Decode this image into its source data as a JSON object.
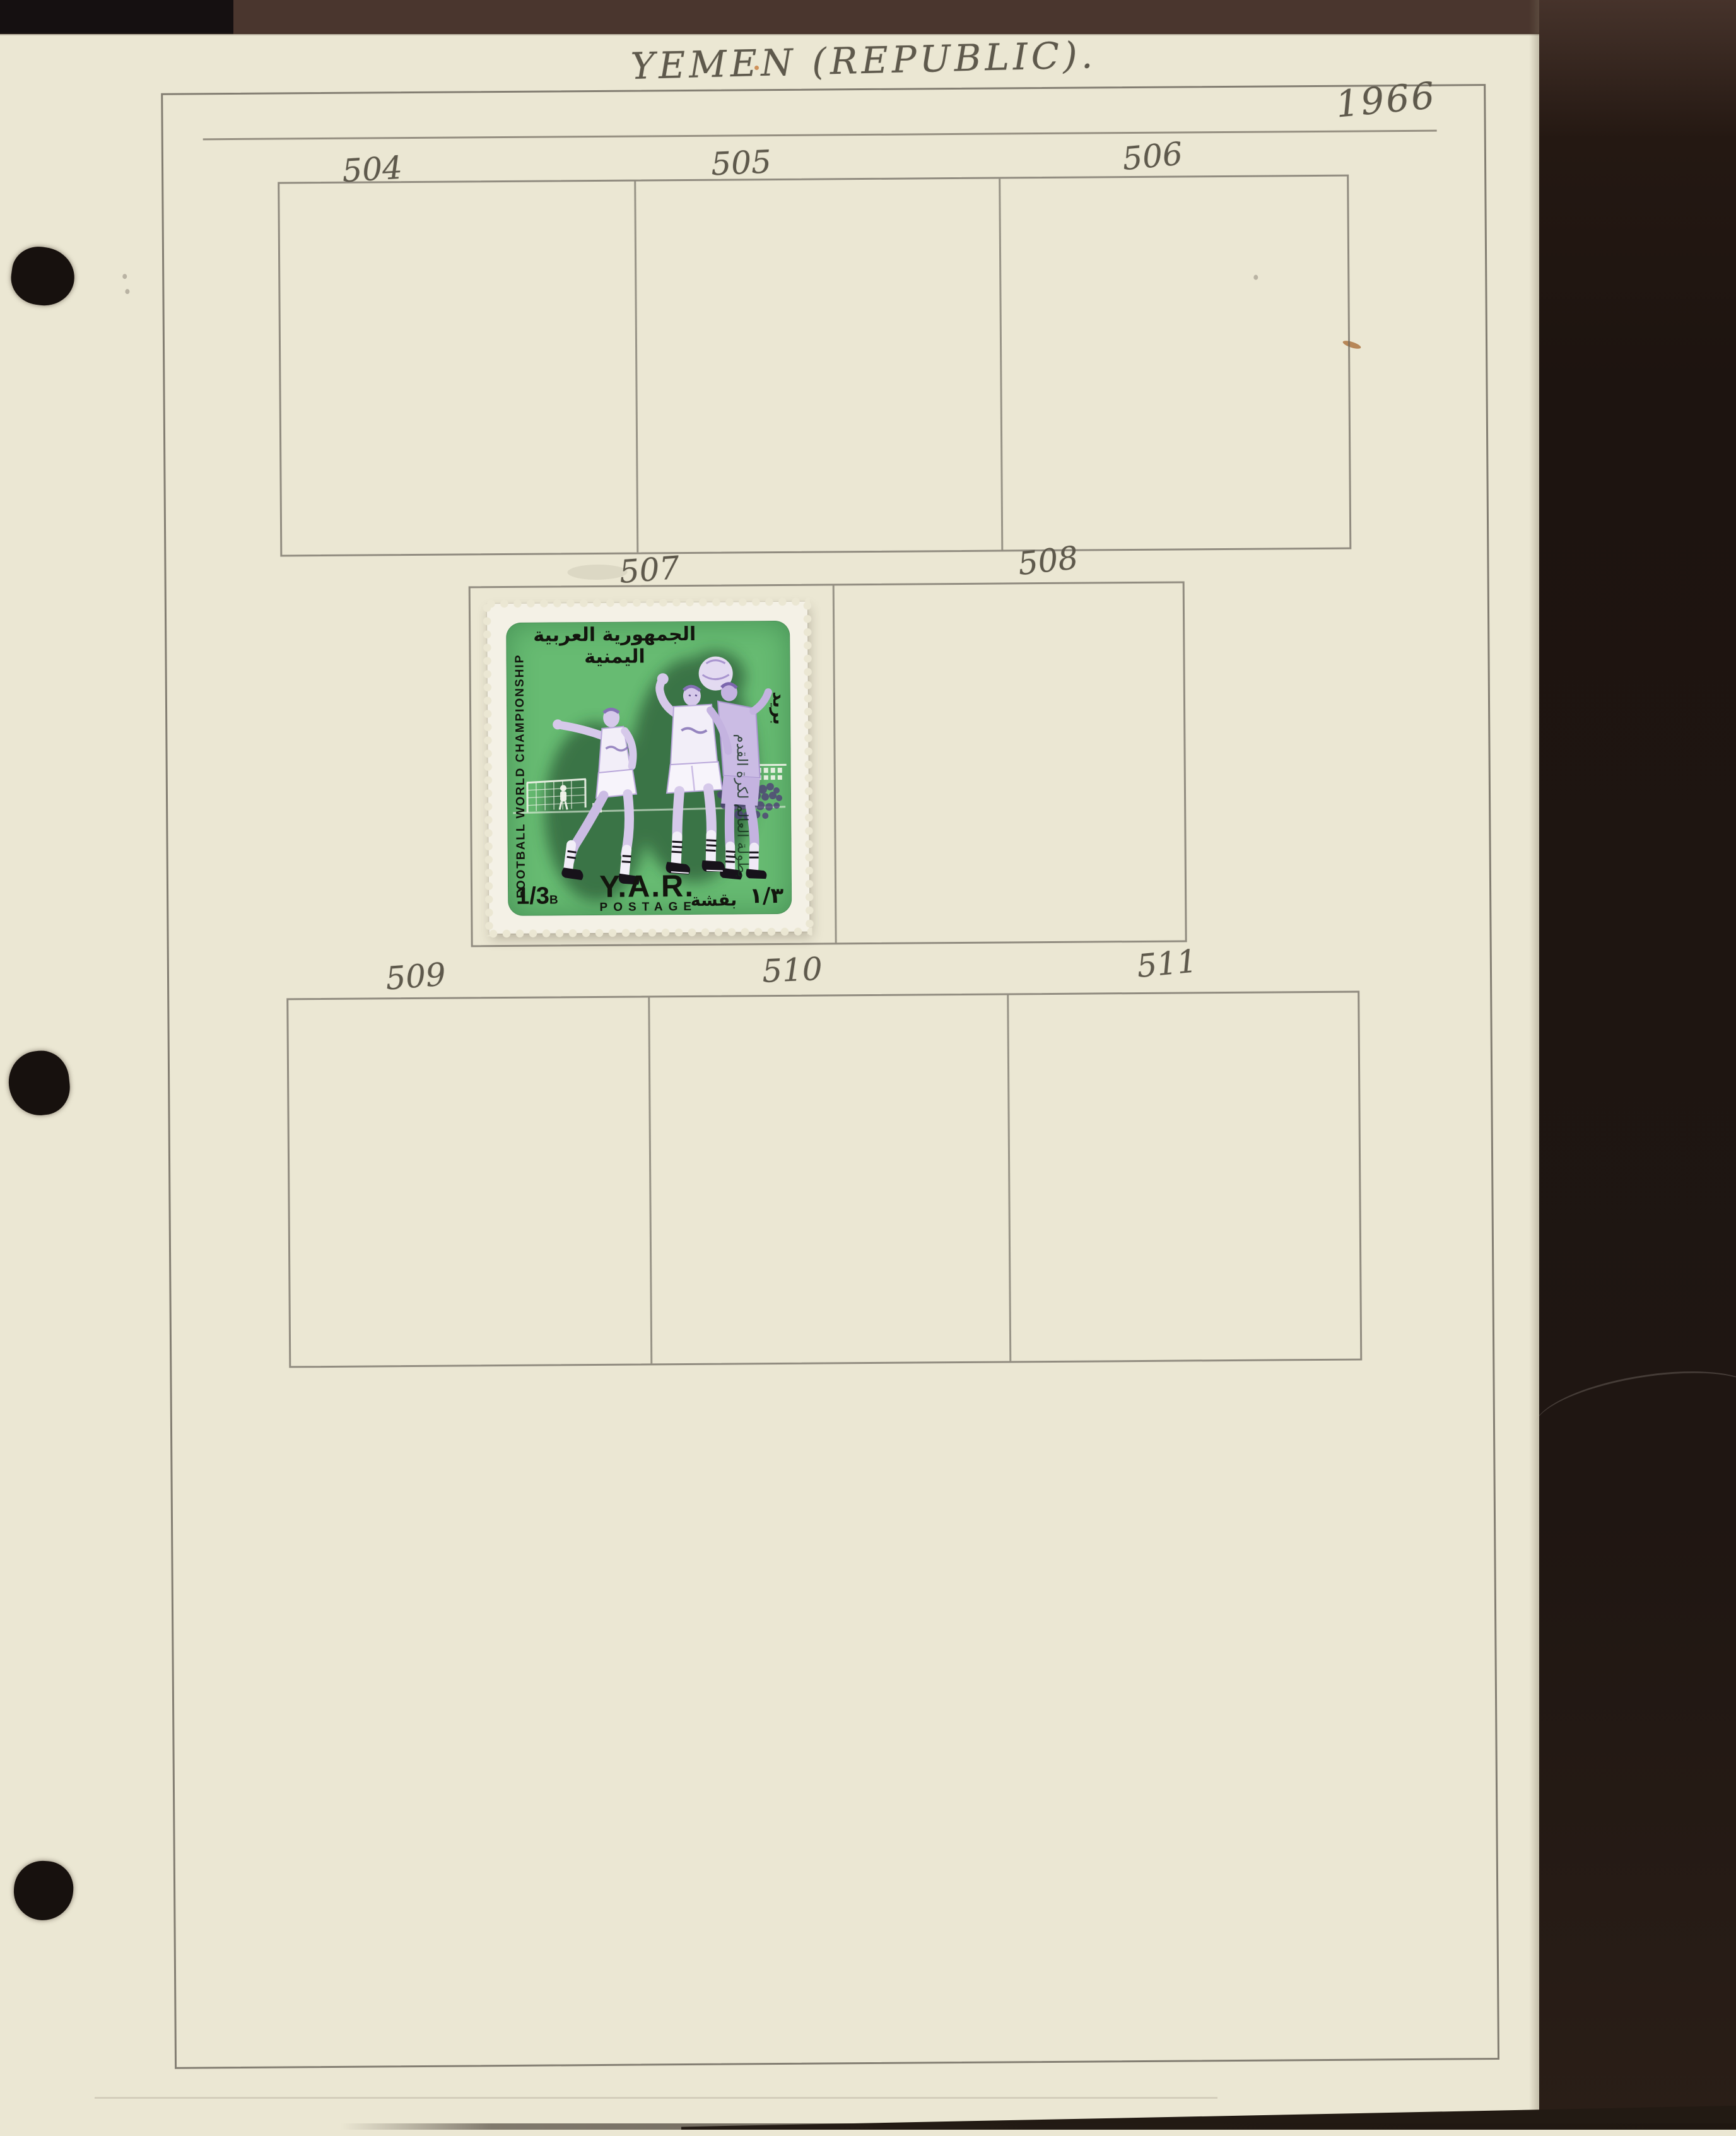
{
  "page": {
    "title": "YEMEN (REPUBLIC).",
    "year": "1966"
  },
  "boxes": {
    "row1": [
      "504",
      "505",
      "506"
    ],
    "row2": [
      "507",
      "508"
    ],
    "row3": [
      "509",
      "510",
      "511"
    ]
  },
  "stamp": {
    "arabic_country": "الجمهورية العربية اليمنية",
    "arabic_postage": "بريد",
    "arabic_event": "بطولة العالم لكرة القدم",
    "event": "FOOTBALL WORLD CHAMPIONSHIP",
    "value": "1/3",
    "unit": "B",
    "country": "Y.A.R.",
    "postage": "POSTAGE",
    "arabic_value": "١/٣",
    "arabic_unit": "بقشة"
  },
  "colors": {
    "page_cream": "#ebe7d3",
    "pencil_gray": "#8c8679",
    "stamp_green": "#67bb72",
    "player_lilac": "#d6c9ea",
    "binder_brown": "#4a362e",
    "binder_dark": "#1f1612",
    "stamp_ink": "#13150e"
  }
}
